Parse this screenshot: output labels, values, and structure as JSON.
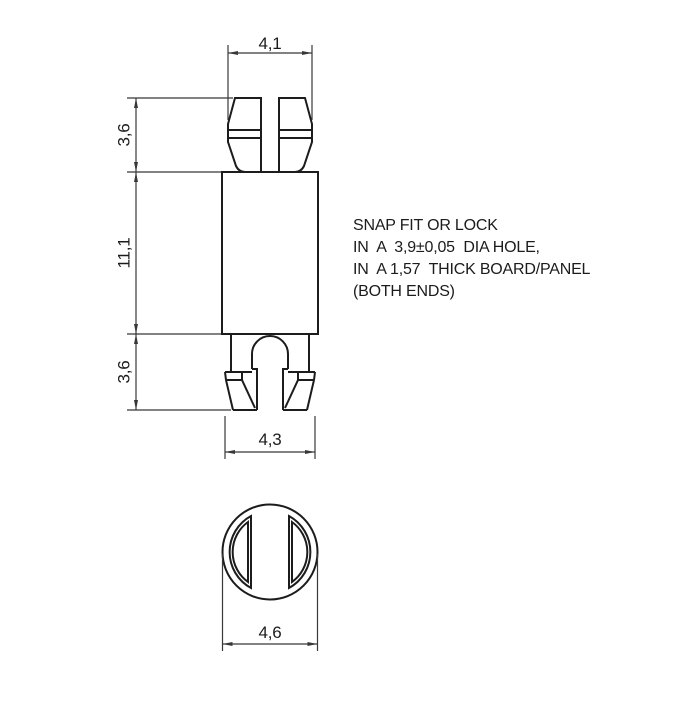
{
  "front_view": {
    "dim_top_width": "4,1",
    "dim_upper_height": "3,6",
    "dim_body_height": "11,1",
    "dim_lower_height": "3,6",
    "dim_bottom_width": "4,3"
  },
  "bottom_view": {
    "dim_diameter": "4,6"
  },
  "note": {
    "lines": [
      "SNAP FIT OR LOCK",
      "IN  A  3,9±0,05  DIA HOLE,",
      "IN  A 1,57  THICK BOARD/PANEL",
      "(BOTH ENDS)"
    ]
  },
  "colors": {
    "outline": "#1c1c1c",
    "dimension": "#383838",
    "text": "#1c1c1c",
    "background": "#ffffff"
  }
}
